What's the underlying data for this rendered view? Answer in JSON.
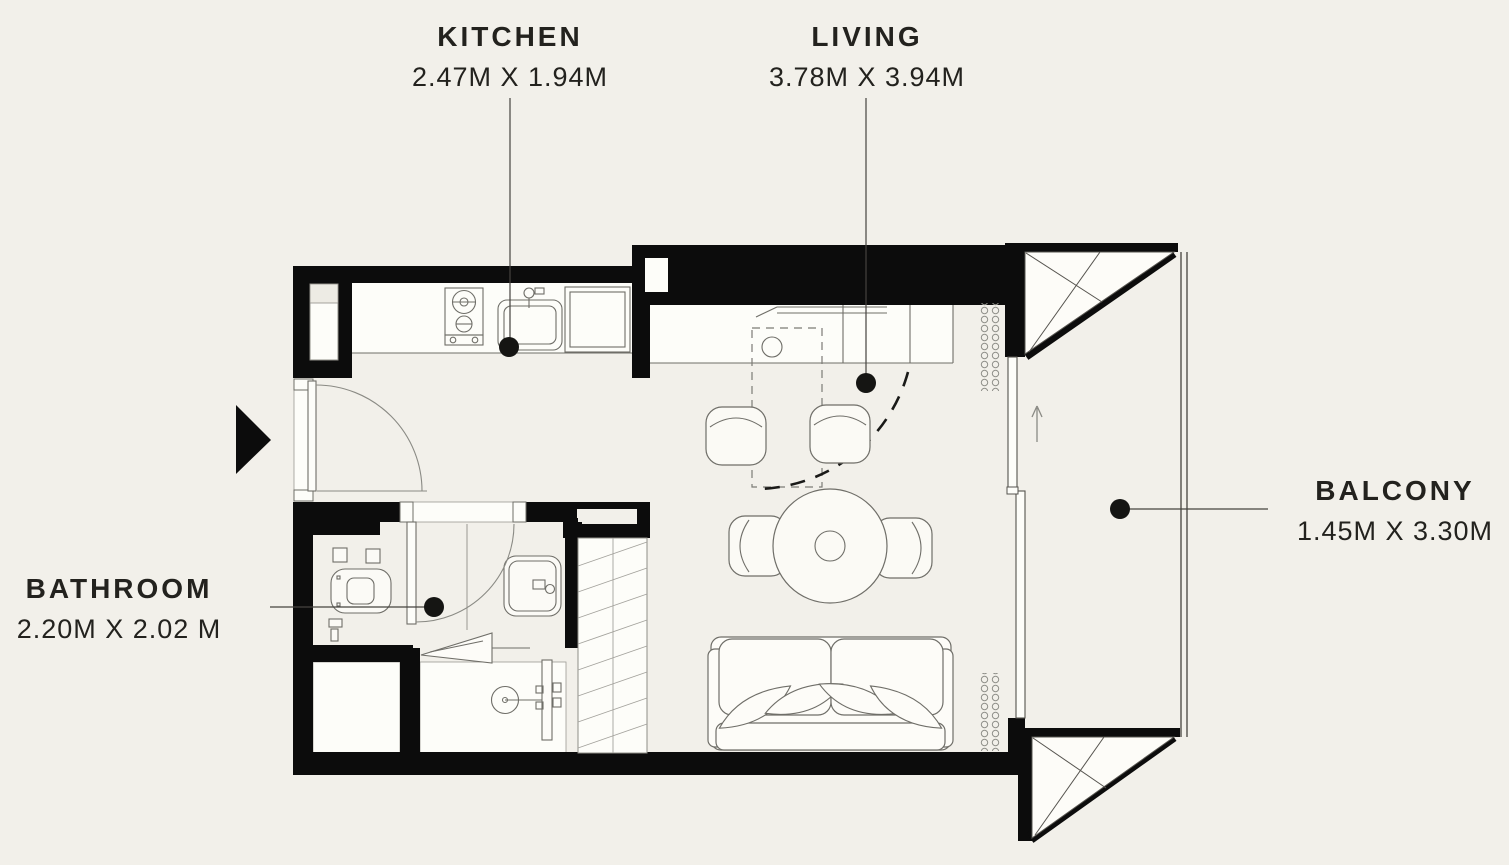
{
  "canvas": {
    "background": "#f2f0ea",
    "wall_color": "#0c0c0c",
    "line_color": "#6f6e68",
    "text_color": "#23221e"
  },
  "rooms": {
    "kitchen": {
      "label": "KITCHEN",
      "size": "2.47M X 1.94M"
    },
    "living": {
      "label": "LIVING",
      "size": "3.78M X 3.94M"
    },
    "bathroom": {
      "label": "BATHROOM",
      "size": "2.20M X 2.02 M"
    },
    "balcony": {
      "label": "BALCONY",
      "size": "1.45M X 3.30M"
    }
  },
  "fixtures": [
    "entry-arrow",
    "entry-door",
    "two-burner-stove",
    "kitchen-sink",
    "refrigerator",
    "toilet",
    "washbasin",
    "shower-head",
    "shower-glass-door",
    "service-shaft-hatch",
    "console-counter",
    "round-dining-table",
    "dining-chair",
    "sofa-two-seat",
    "radiator-coil",
    "sliding-balcony-door",
    "balcony-railing",
    "balcony-corner-brace"
  ]
}
